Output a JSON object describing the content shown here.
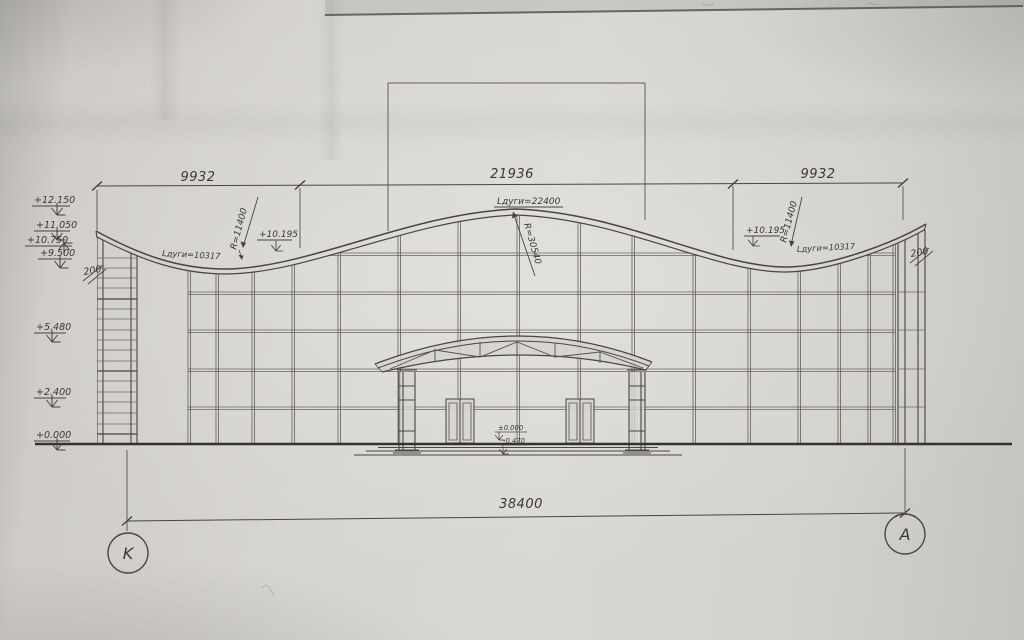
{
  "annotations": {
    "dim_top_left": "9932",
    "dim_top_center": "21936",
    "dim_top_right": "9932",
    "dim_bottom": "38400",
    "axis_left": "K",
    "axis_right": "A",
    "levels_left": [
      "+12.150",
      "+11.050",
      "+10.750",
      "+9.500",
      "+5.480",
      "+2.400",
      "+0.000"
    ],
    "roof": {
      "radius_side_left": "R=11400",
      "radius_side_right": "R=11400",
      "radius_center": "R=30540",
      "arc_left": "Lдуги=10317",
      "arc_center": "Lдуги=22400",
      "arc_right": "Lдуги=10317",
      "level_left": "+10.195",
      "level_right": "+10.195"
    },
    "thickness_left": "200",
    "thickness_right": "200",
    "entrance": {
      "level_zero": "±0.000",
      "level_minus": "-0.470"
    }
  },
  "colors": {
    "ink": "#49463f",
    "paper": "#d7d5d0"
  }
}
